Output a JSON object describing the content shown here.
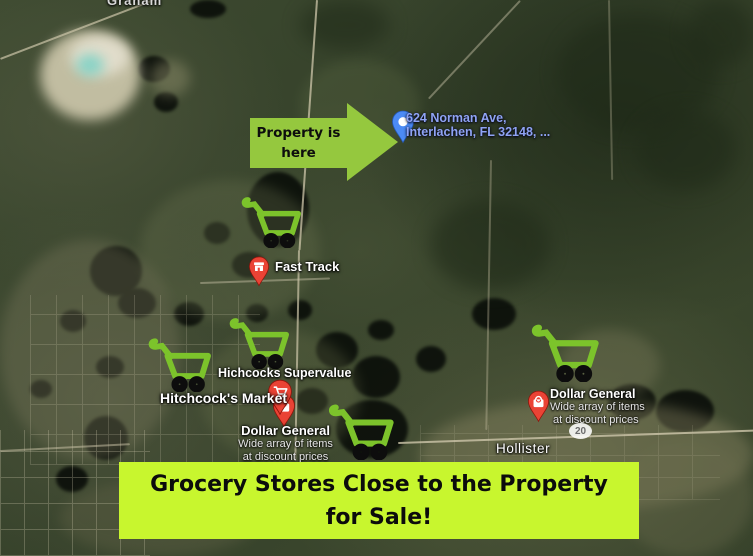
{
  "map": {
    "top_place_label": "Graham",
    "town_label": "Hollister",
    "road_shield_label": "20",
    "property_pin": {
      "address_line1": "624 Norman Ave,",
      "address_line2": "Interlachen, FL 32148, ..."
    },
    "pois": {
      "fast_track": {
        "name": "Fast Track",
        "icon": "convenience-store-pin-icon"
      },
      "hichcocks_supervalue": {
        "name": "Hichcocks Supervalue"
      },
      "hitchcocks_market": {
        "name": "Hitchcock's Market",
        "icon": "grocery-cart-pin-icon"
      },
      "dollar_general_west": {
        "name": "Dollar General",
        "subtitle_line1": "Wide array of items",
        "subtitle_line2": "at discount prices",
        "icon": "shopping-bag-pin-icon"
      },
      "dollar_general_east": {
        "name": "Dollar General",
        "subtitle_line1": "Wide array of items",
        "subtitle_line2": "at discount prices",
        "icon": "shopping-bag-pin-icon"
      }
    }
  },
  "annotations": {
    "arrow_callout": {
      "line1": "Property is",
      "line2": "here"
    },
    "banner": {
      "line1": "Grocery Stores Close to the Property",
      "line2": "for Sale!"
    },
    "cart_marker_count": 5,
    "cart_marker_icon": "shopping-cart-icon"
  },
  "colors": {
    "arrow_green": "#95C83E",
    "cart_green": "#7CC32B",
    "banner_green": "#C8F62E",
    "pin_red": "#EA4335",
    "pin_blue": "#4C8BF5",
    "address_text_blue": "#8FA3F4"
  }
}
